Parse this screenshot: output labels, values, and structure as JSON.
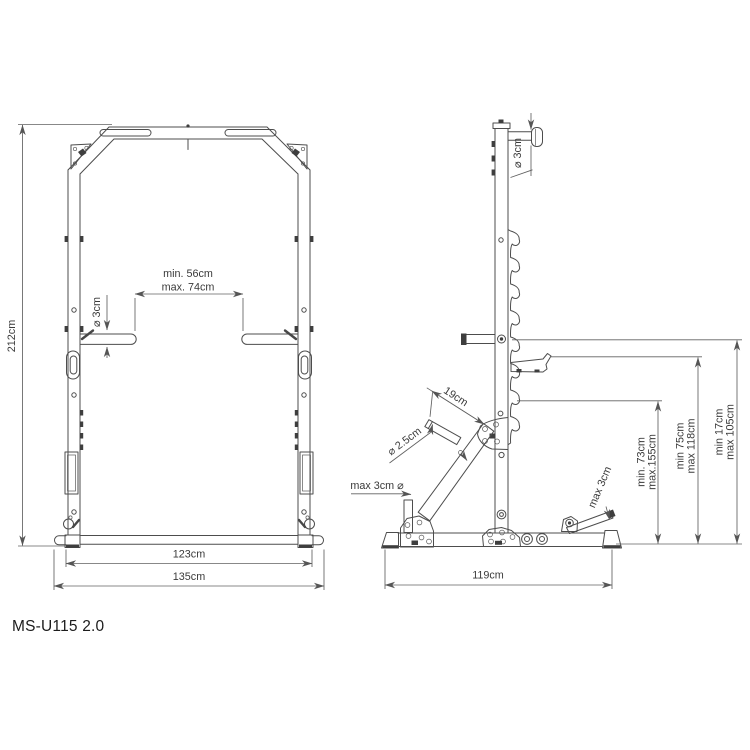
{
  "title": "MS-U115 2.0",
  "front_view": {
    "total_height": "212cm",
    "arm_span_min": "min. 56cm",
    "arm_span_max": "max. 74cm",
    "arm_diameter": "⌀ 3cm",
    "inner_base_width": "123cm",
    "outer_base_width": "135cm"
  },
  "side_view": {
    "grip_diameter": "⌀ 3cm",
    "peg_length": "19cm",
    "peg_diameter": "⌀ 2.5cm",
    "front_bar_diameter": "max 3cm ⌀",
    "rear_bar_diameter": "max 3cm",
    "jhook_height_min": "min. 73cm",
    "jhook_height_max": "max.155cm",
    "mid_height_min": "min 75cm",
    "mid_height_max": "max 118cm",
    "low_height_min": "min 17cm",
    "low_height_max": "max 105cm",
    "base_depth": "119cm"
  }
}
